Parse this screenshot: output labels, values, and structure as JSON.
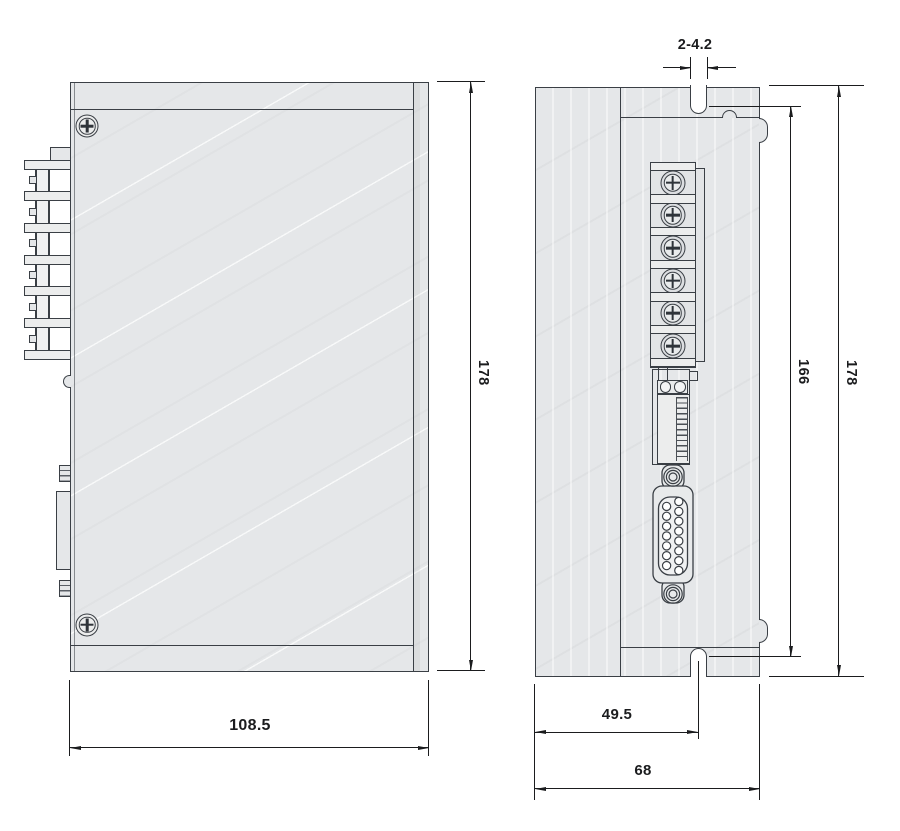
{
  "colors": {
    "background": "#ffffff",
    "outline": "#3a3f45",
    "dimension": "#1b1c1e",
    "body_fill": "#e5e7e9",
    "slot_fill": "#ffffff"
  },
  "dims": {
    "slot_width": "2-4.2",
    "side_height": "178",
    "front_mount_span": "166",
    "front_height": "178",
    "side_width": "108.5",
    "slot_offset": "49.5",
    "front_width": "68"
  }
}
